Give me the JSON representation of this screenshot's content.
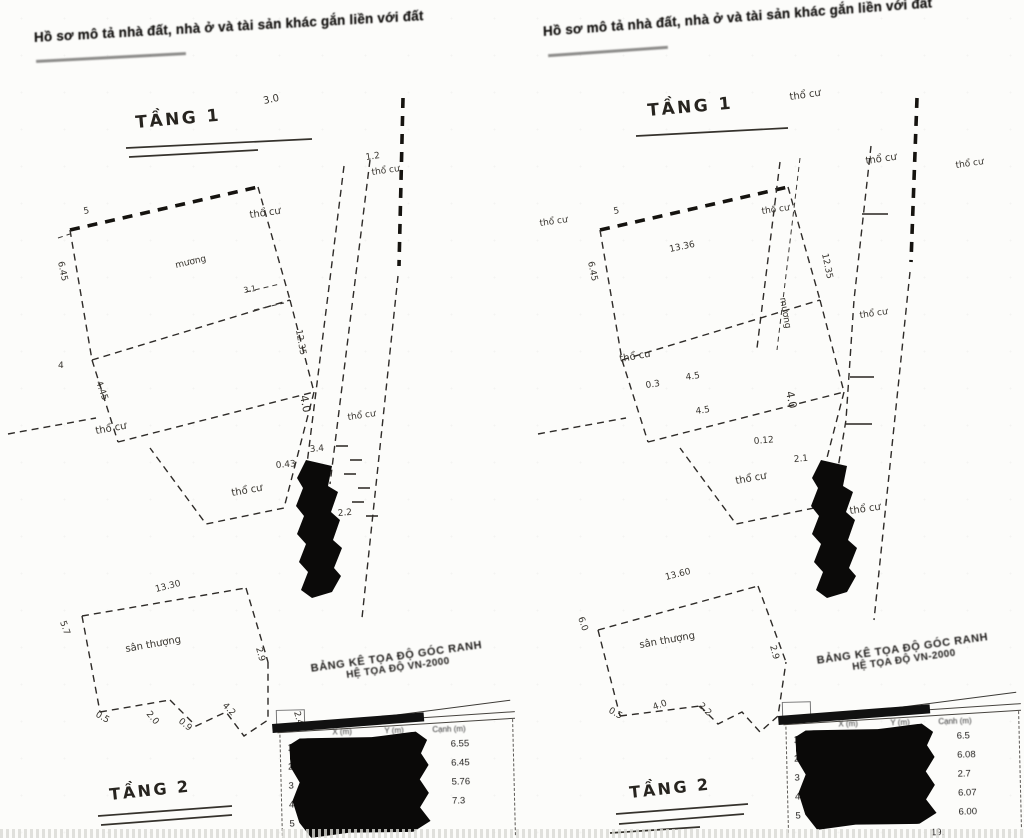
{
  "headers": {
    "left": "Hồ sơ mô tả nhà đất, nhà ở và tài sản khác gắn liền với đất",
    "right": "Hồ sơ mô tả nhà đất, nhà ở và tài sản khác gắn liền với đất"
  },
  "drawings": {
    "left_floor1": {
      "title": "TẦNG 1",
      "labels": [
        {
          "t": "5",
          "x": 84,
          "y": 214,
          "r": -10,
          "s": 9
        },
        {
          "t": "3.0",
          "x": 264,
          "y": 104,
          "r": -12,
          "s": 10
        },
        {
          "t": "thổ cư",
          "x": 250,
          "y": 218,
          "r": -8,
          "s": 10,
          "n": "land-use-label"
        },
        {
          "t": "1.2",
          "x": 366,
          "y": 160,
          "r": -8,
          "s": 9
        },
        {
          "t": "thổ cư",
          "x": 372,
          "y": 175,
          "r": -8,
          "s": 9,
          "n": "land-use-label"
        },
        {
          "t": "mương",
          "x": 176,
          "y": 268,
          "r": -13,
          "s": 9
        },
        {
          "t": "3.1",
          "x": 244,
          "y": 293,
          "r": -10,
          "s": 8
        },
        {
          "t": "6.45",
          "x": 58,
          "y": 262,
          "r": 78,
          "s": 9
        },
        {
          "t": "4",
          "x": 58,
          "y": 368,
          "r": 0,
          "s": 9
        },
        {
          "t": "4.45",
          "x": 96,
          "y": 382,
          "r": 70,
          "s": 9
        },
        {
          "t": "4.0",
          "x": 300,
          "y": 396,
          "r": 78,
          "s": 11
        },
        {
          "t": "12.35",
          "x": 296,
          "y": 330,
          "r": 80,
          "s": 9
        },
        {
          "t": "3.4",
          "x": 310,
          "y": 452,
          "r": -5,
          "s": 9
        },
        {
          "t": "0.43",
          "x": 276,
          "y": 468,
          "r": -5,
          "s": 9
        },
        {
          "t": "2.2",
          "x": 338,
          "y": 516,
          "r": -5,
          "s": 9
        },
        {
          "t": "thổ cư",
          "x": 96,
          "y": 434,
          "r": -10,
          "s": 10,
          "n": "land-use-label"
        },
        {
          "t": "thổ cư",
          "x": 232,
          "y": 496,
          "r": -10,
          "s": 10,
          "n": "land-use-label"
        },
        {
          "t": "thổ cư",
          "x": 348,
          "y": 420,
          "r": -8,
          "s": 9,
          "n": "land-use-label"
        }
      ]
    },
    "left_floor2": {
      "title": "TẦNG 2",
      "labels": [
        {
          "t": "13.30",
          "x": 156,
          "y": 592,
          "r": -14,
          "s": 9
        },
        {
          "t": "5.7",
          "x": 60,
          "y": 622,
          "r": 70,
          "s": 9
        },
        {
          "t": "sân thượng",
          "x": 126,
          "y": 652,
          "r": -10,
          "s": 10,
          "n": "area-label"
        },
        {
          "t": "0.5",
          "x": 95,
          "y": 716,
          "r": 30,
          "s": 9
        },
        {
          "t": "2.0",
          "x": 146,
          "y": 714,
          "r": 50,
          "s": 9
        },
        {
          "t": "0.9",
          "x": 178,
          "y": 722,
          "r": 40,
          "s": 9
        },
        {
          "t": "4.2",
          "x": 222,
          "y": 706,
          "r": 45,
          "s": 9
        },
        {
          "t": "2.9",
          "x": 256,
          "y": 648,
          "r": 75,
          "s": 9
        },
        {
          "t": "2.40",
          "x": 294,
          "y": 712,
          "r": 75,
          "s": 9
        },
        {
          "t": "1.2",
          "x": 318,
          "y": 744,
          "r": 75,
          "s": 9
        }
      ]
    },
    "right_floor1": {
      "title": "TẦNG 1",
      "labels": [
        {
          "t": "5",
          "x": 614,
          "y": 214,
          "r": -10,
          "s": 9
        },
        {
          "t": "thổ cư",
          "x": 790,
          "y": 100,
          "r": -8,
          "s": 10,
          "n": "land-use-label"
        },
        {
          "t": "13.36",
          "x": 670,
          "y": 252,
          "r": -12,
          "s": 9
        },
        {
          "t": "thổ cư",
          "x": 762,
          "y": 214,
          "r": -8,
          "s": 9,
          "n": "land-use-label"
        },
        {
          "t": "thổ cư",
          "x": 866,
          "y": 164,
          "r": -8,
          "s": 10,
          "n": "land-use-label"
        },
        {
          "t": "thổ cư",
          "x": 540,
          "y": 226,
          "r": -8,
          "s": 9,
          "n": "land-use-label"
        },
        {
          "t": "mương",
          "x": 780,
          "y": 298,
          "r": 80,
          "s": 9
        },
        {
          "t": "6.45",
          "x": 588,
          "y": 262,
          "r": 78,
          "s": 9
        },
        {
          "t": "0.3",
          "x": 646,
          "y": 388,
          "r": -8,
          "s": 9
        },
        {
          "t": "4.5",
          "x": 686,
          "y": 380,
          "r": -8,
          "s": 9
        },
        {
          "t": "4.5",
          "x": 696,
          "y": 414,
          "r": -8,
          "s": 9
        },
        {
          "t": "4.0",
          "x": 786,
          "y": 392,
          "r": 78,
          "s": 11
        },
        {
          "t": "0.12",
          "x": 754,
          "y": 444,
          "r": -5,
          "s": 9
        },
        {
          "t": "2.1",
          "x": 794,
          "y": 462,
          "r": -5,
          "s": 9
        },
        {
          "t": "12.35",
          "x": 822,
          "y": 254,
          "r": 78,
          "s": 9
        },
        {
          "t": "thổ cư",
          "x": 620,
          "y": 362,
          "r": -10,
          "s": 10,
          "n": "land-use-label"
        },
        {
          "t": "thổ cư",
          "x": 736,
          "y": 484,
          "r": -10,
          "s": 10,
          "n": "land-use-label"
        },
        {
          "t": "thổ cư",
          "x": 850,
          "y": 514,
          "r": -8,
          "s": 10,
          "n": "land-use-label"
        },
        {
          "t": "thổ cư",
          "x": 860,
          "y": 318,
          "r": -8,
          "s": 9,
          "n": "land-use-label"
        },
        {
          "t": "thổ cư",
          "x": 956,
          "y": 168,
          "r": -8,
          "s": 9,
          "n": "land-use-label"
        }
      ]
    },
    "right_floor2": {
      "title": "TẦNG 2",
      "labels": [
        {
          "t": "13.60",
          "x": 666,
          "y": 580,
          "r": -14,
          "s": 9
        },
        {
          "t": "6.0",
          "x": 578,
          "y": 618,
          "r": 70,
          "s": 9
        },
        {
          "t": "sân thượng",
          "x": 640,
          "y": 648,
          "r": -10,
          "s": 10,
          "n": "area-label"
        },
        {
          "t": "0.5",
          "x": 608,
          "y": 712,
          "r": 30,
          "s": 9
        },
        {
          "t": "4.0",
          "x": 654,
          "y": 710,
          "r": -20,
          "s": 9
        },
        {
          "t": "2.2",
          "x": 698,
          "y": 706,
          "r": 45,
          "s": 9
        },
        {
          "t": "2.9",
          "x": 770,
          "y": 646,
          "r": 75,
          "s": 9
        }
      ]
    }
  },
  "tables": {
    "left": {
      "title1": "BẢNG KÊ TỌA ĐỘ GÓC RANH",
      "title2": "HỆ TỌA ĐỘ VN-2000",
      "headers": [
        "X (m)",
        "Y (m)",
        "Cạnh (m)"
      ],
      "rows": [
        {
          "no": "1",
          "val": "6.55"
        },
        {
          "no": "2",
          "val": "6.45"
        },
        {
          "no": "3",
          "val": "5.76"
        },
        {
          "no": "4",
          "val": "7.3"
        },
        {
          "no": "5",
          "val": ""
        }
      ]
    },
    "right": {
      "title1": "BẢNG KÊ TỌA ĐỘ GÓC RANH",
      "title2": "HỆ TỌA ĐỘ VN-2000",
      "headers": [
        "X (m)",
        "Y (m)",
        "Cạnh (m)"
      ],
      "rows": [
        {
          "no": "1",
          "val": "6.5"
        },
        {
          "no": "2",
          "val": "6.08"
        },
        {
          "no": "3",
          "val": "2.7"
        },
        {
          "no": "4",
          "val": "6.07"
        },
        {
          "no": "5",
          "val": "6.00"
        }
      ],
      "footer": "19."
    }
  }
}
